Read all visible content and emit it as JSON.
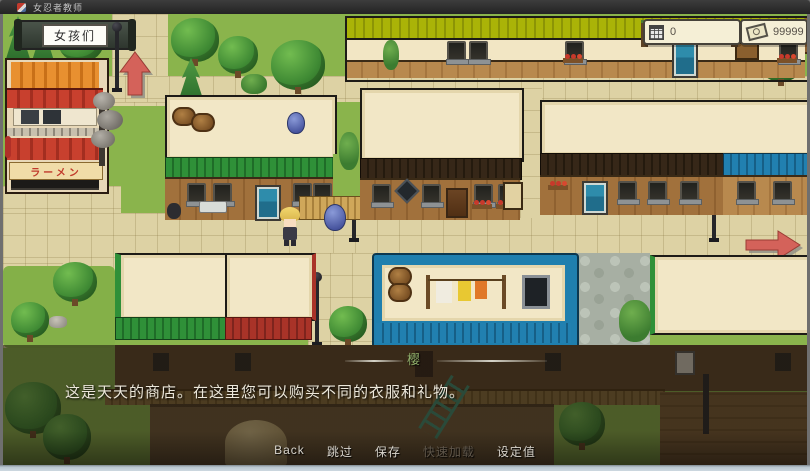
{
  "window": {
    "title": "女忍者教师"
  },
  "hud": {
    "location_banner": "女孩们",
    "day_counter": {
      "icon": "calculator-icon",
      "value": "0"
    },
    "money_counter": {
      "icon": "banknote-icon",
      "value": "99999"
    }
  },
  "map": {
    "ramen_shop_sign": "ラーメン",
    "exits": [
      "up-arrow",
      "right-arrow"
    ]
  },
  "dialog": {
    "speaker_name": "樱",
    "text": "这是天天的商店。在这里您可以购买不同的衣服和礼物。"
  },
  "menu": {
    "items": [
      {
        "label": "Back",
        "enabled": true
      },
      {
        "label": "跳过",
        "enabled": true
      },
      {
        "label": "保存",
        "enabled": true
      },
      {
        "label": "快速加载",
        "enabled": false
      },
      {
        "label": "设定值",
        "enabled": true
      }
    ]
  },
  "colors": {
    "accent_arrow": "#d4625a",
    "speaker_name": "#8fae6a",
    "menu_enabled": "#d8d4cc",
    "menu_disabled": "#5f564a",
    "counter_text": "#565048"
  }
}
